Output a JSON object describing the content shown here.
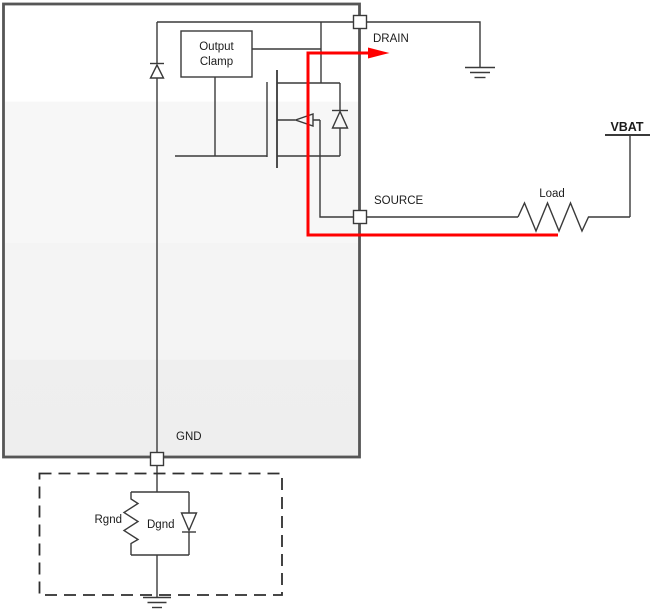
{
  "schematic": {
    "ic": {
      "pins": {
        "drain": "DRAIN",
        "source": "SOURCE",
        "gnd": "GND"
      },
      "output_clamp": {
        "line1": "Output",
        "line2": "Clamp"
      }
    },
    "external": {
      "supply": "VBAT",
      "load": "Load",
      "ground_network": {
        "resistor": "Rgnd",
        "diode": "Dgnd"
      }
    },
    "colors": {
      "current_path_red": "#ff0000",
      "wire": "#3a3a3a",
      "ic_border": "#565656",
      "dashed_border": "#2f2f2f",
      "text": "#1c1c1c",
      "ic_fill_top": "#ffffff",
      "ic_fill_bottom": "#efefef"
    }
  }
}
